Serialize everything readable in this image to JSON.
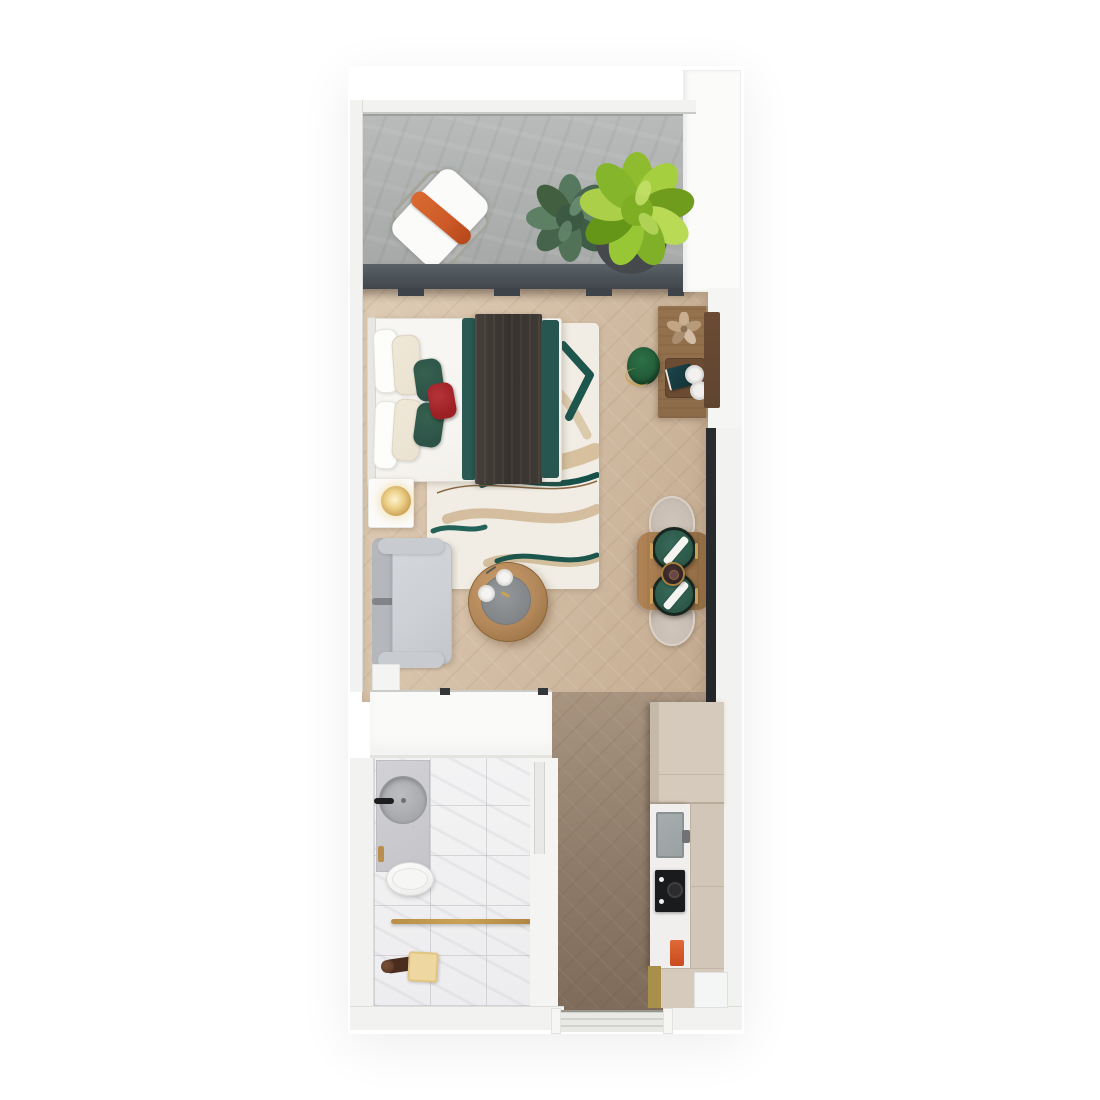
{
  "scene": {
    "kind": "3d-floor-plan-render",
    "description": "Top-down 3D render of a studio apartment: balcony at top, combined sleeping/living room, bathroom, entry corridor and galley kitchen at bottom",
    "text_labels": []
  },
  "palette": {
    "bg": "#ffffff",
    "wall": "#f2f2f0",
    "wallEdge": "#dcdcd9",
    "concrete": "#b0b3b2",
    "doorBand": "#494f55",
    "windowStrip": "#24272a",
    "woodFloor": "#d5c0a8",
    "woodFloorDark": "#c3ab90",
    "corridorFloor": "#8d7a68",
    "marble": "#f3f3f4",
    "rugBase": "#f1ede4",
    "rugTeal": "#1d564d",
    "rugTan": "#bf9a64",
    "duvet": "#f7f5f1",
    "pillowBeige": "#eae2d1",
    "pillowGreen": "#2d5348",
    "pillowRed": "#9c1f23",
    "blanketDark": "#38322f",
    "blanketTeal": "#2a5a53",
    "sofaGray": "#cdd0d4",
    "sofaBack": "#b4b8bd",
    "woodTable": "#b2875a",
    "woodDesk": "#8d6c4a",
    "benchBrown": "#5f4531",
    "stoolGreen": "#1f5634",
    "plateGreen": "#2b5748",
    "gold": "#c9a258",
    "chairBeige": "#c9beb3",
    "lampGold": "#d8b06a",
    "orangePillow": "#cd5a28",
    "plantDark": "#54765c",
    "plantBright": "#93c335",
    "potDark": "#45494c",
    "cabinetBeige": "#d6cabc",
    "counterWhite": "#f0efed",
    "cooktopBlack": "#1a1b1d",
    "sinkGray": "#9aa1a3",
    "accentRed": "#c94b20",
    "accentMustard": "#a98f4c",
    "towelBeige": "#eed7a0"
  },
  "rooms": {
    "balcony": {
      "label": "Balcony with concrete floor"
    },
    "living": {
      "label": "Combined sleeping and living area"
    },
    "bathroom": {
      "label": "Bathroom with marble floor"
    },
    "corridor": {
      "label": "Entry corridor"
    },
    "kitchen": {
      "label": "Galley kitchenette"
    }
  },
  "furniture": {
    "loungeChair": {
      "label": "Balcony lounge chair with orange pillow"
    },
    "plantDark": {
      "label": "Sage green potted plant"
    },
    "plantBright": {
      "label": "Lime green potted plant"
    },
    "bed": {
      "label": "Double bed with teal and red pillows"
    },
    "blanket": {
      "label": "Dark runner blanket with teal edges"
    },
    "rug": {
      "label": "Cream rug with teal and tan pattern"
    },
    "nightstand": {
      "label": "Nightstand with brass lamp"
    },
    "sofa": {
      "label": "Gray sofa"
    },
    "coffeeTable": {
      "label": "Round wooden coffee table with tray"
    },
    "desk": {
      "label": "Wooden console desk with flowers and tray"
    },
    "stool": {
      "label": "Green velvet stool"
    },
    "diningTable": {
      "label": "Dining table set for two"
    },
    "wardrobe": {
      "label": "White wardrobe unit"
    },
    "vanity": {
      "label": "Stone vanity with round basin"
    },
    "toilet": {
      "label": "Toilet"
    },
    "shower": {
      "label": "Shower area with brass towel bar"
    },
    "kitchenRun": {
      "label": "Kitchen run with sink and cooktop"
    },
    "entry": {
      "label": "Entry door threshold"
    }
  }
}
